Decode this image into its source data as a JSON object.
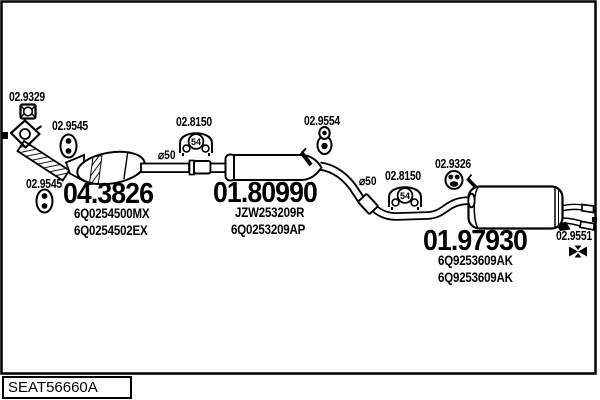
{
  "doc": {
    "drawing_number": "SEAT56660A"
  },
  "callouts": {
    "front_flange": {
      "code": "02.9329"
    },
    "front_hanger_upper": {
      "code": "02.9545"
    },
    "front_hanger_lower": {
      "code": "02.9545"
    },
    "catalyst": {
      "code": "04.3826",
      "parts": [
        "6Q0254500MX",
        "6Q0254502EX"
      ]
    },
    "front_clamp": {
      "code": "02.8150",
      "size": "54"
    },
    "front_pipe_diameter": "⌀50",
    "centre_muffler": {
      "code": "01.80990",
      "parts": [
        "JZW253209R",
        "6Q0253209AP"
      ]
    },
    "centre_hanger": {
      "code": "02.9554"
    },
    "rear_pipe_diameter": "⌀50",
    "rear_clamp": {
      "code": "02.8150",
      "size": "54"
    },
    "rear_grommet": {
      "code": "02.9326"
    },
    "rear_muffler": {
      "code": "01.97930",
      "parts": [
        "6Q9253609AK",
        "6Q9253609AK"
      ]
    },
    "tailpipe_bracket": {
      "code": "02.9551"
    }
  },
  "colors": {
    "line": "#000000",
    "background": "#ffffff"
  }
}
